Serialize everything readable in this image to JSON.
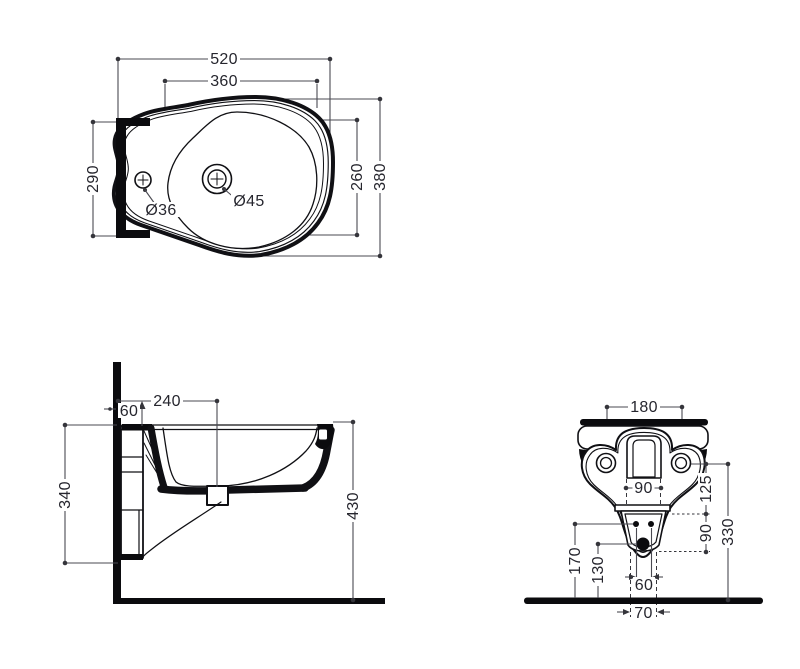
{
  "document": {
    "type": "technical-drawing",
    "subject": "wall-hung bidet dimensional drawing",
    "background_color": "#ffffff"
  },
  "colors": {
    "object_line": "#101014",
    "dimension_line": "#4a4a52",
    "text": "#26262e"
  },
  "views": {
    "plan": {
      "label": "plan-view",
      "dims": {
        "overall_width": "520",
        "bowl_width": "360",
        "wall_side_depth": "290",
        "bowl_depth": "260",
        "overall_depth": "380",
        "faucet_hole_diameter": "Ø36",
        "drain_hole_diameter": "Ø45"
      }
    },
    "side": {
      "label": "side-view",
      "dims": {
        "drain_center_from_wall": "240",
        "wall_clearance": "60",
        "mounting_plate_height": "340",
        "rim_height_from_floor": "430"
      }
    },
    "rear": {
      "label": "rear-view",
      "dims": {
        "fixing_hole_spacing": "180",
        "inlet_opening_width": "90",
        "fixing_to_shelf_offset": "125",
        "fixing_hole_height": "330",
        "shelf_to_outlet_offset": "90",
        "bolt_hole_height": "170",
        "outlet_height": "130",
        "bolt_hole_spacing": "60",
        "drain_outlet_spacing": "70"
      }
    }
  }
}
